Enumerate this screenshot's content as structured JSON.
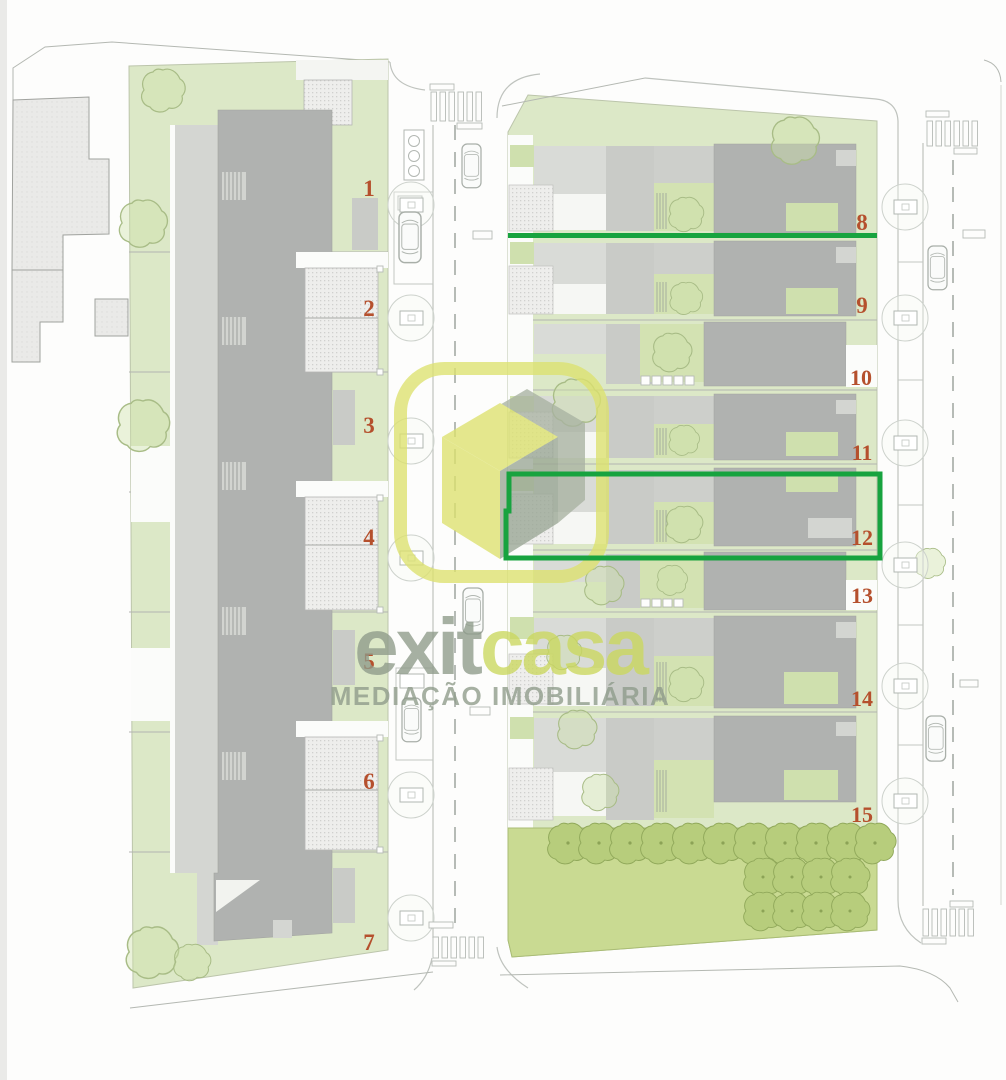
{
  "plan": {
    "type": "residential site plan",
    "lots": {
      "left": [
        {
          "label": "1"
        },
        {
          "label": "2"
        },
        {
          "label": "3"
        },
        {
          "label": "4"
        },
        {
          "label": "5"
        },
        {
          "label": "6"
        },
        {
          "label": "7"
        }
      ],
      "right": [
        {
          "label": "8"
        },
        {
          "label": "9"
        },
        {
          "label": "10"
        },
        {
          "label": "11"
        },
        {
          "label": "12"
        },
        {
          "label": "13"
        },
        {
          "label": "14"
        },
        {
          "label": "15"
        }
      ]
    },
    "highlights": {
      "color": "#17a33f",
      "underline_lot": "8",
      "boxed_lots": "11-12"
    },
    "colors": {
      "lot_number": "#b5502d",
      "garden": "#dce8c7",
      "garden_dark": "#c9da92",
      "tree_fill": "#b7cd7c",
      "building_dark": "#b0b2b0",
      "building_light": "#d8dad6",
      "road_line": "#b6bbb6",
      "logo_yellow": "#dde26e",
      "logo_gray": "#8e9b8a"
    }
  },
  "logo": {
    "name_part1": "exit",
    "name_part2": "casa",
    "subtitle": "MEDIAÇÃO IMOBILIÁRIA"
  }
}
